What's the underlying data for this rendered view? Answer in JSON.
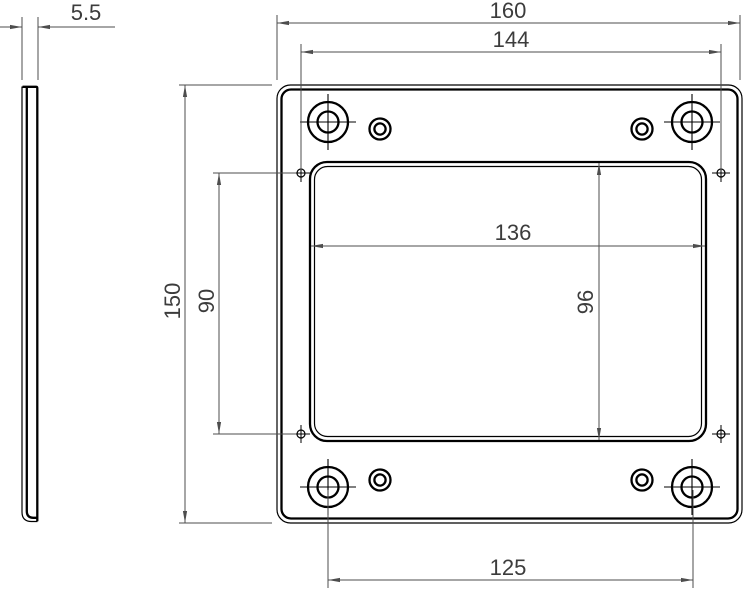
{
  "drawing": {
    "type": "mechanical-part-dimension-drawing",
    "part": "mounting-plate-with-rectangular-cutout",
    "views": {
      "side": {
        "name": "side-view"
      },
      "front": {
        "name": "front-view"
      }
    },
    "dims": {
      "thickness": "5.5",
      "overall_width": "160",
      "upper_pattern_width": "144",
      "cutout_width": "136",
      "cutout_height": "96",
      "left_pattern_height": "90",
      "overall_height": "150",
      "bolt_hole_spacing": "125"
    },
    "colors": {
      "background": "#ffffff",
      "outline": "#000000",
      "dimension_line": "#4d4d4d",
      "text": "#3c3c3c"
    }
  }
}
